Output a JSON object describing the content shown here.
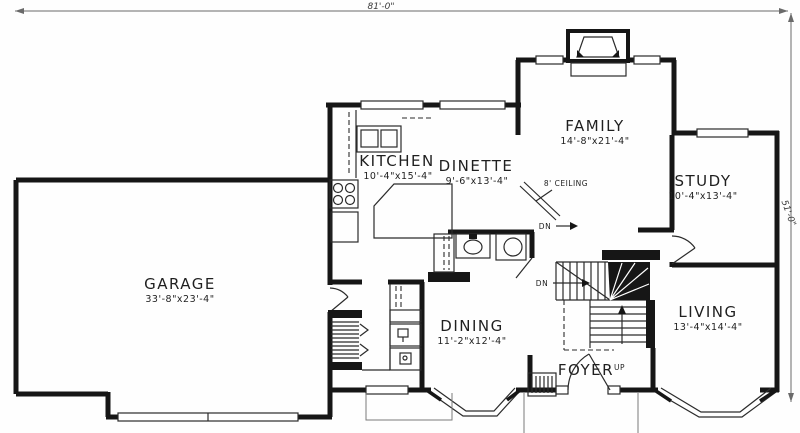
{
  "plan": {
    "type": "first-floor-plan",
    "overall_width": "81'-0\"",
    "overall_depth": "51'-0\""
  },
  "rooms": {
    "garage": {
      "name": "GARAGE",
      "size": "33'-8\"x23'-4\""
    },
    "kitchen": {
      "name": "KITCHEN",
      "size": "10'-4\"x15'-4\""
    },
    "dinette": {
      "name": "DINETTE",
      "size": "9'-6\"x13'-4\""
    },
    "family": {
      "name": "FAMILY",
      "size": "14'-8\"x21'-4\""
    },
    "study": {
      "name": "STUDY",
      "size": "10'-4\"x13'-4\""
    },
    "dining": {
      "name": "DINING",
      "size": "11'-2\"x12'-4\""
    },
    "living": {
      "name": "LIVING",
      "size": "13'-4\"x14'-4\""
    },
    "foyer": {
      "name": "FOYER"
    }
  },
  "notes": {
    "ceiling": "8' CEILING",
    "up": "UP",
    "dn_upper": "DN",
    "dn_lower": "DN"
  },
  "fixtures": [
    "fireplace-icon",
    "kitchen-sink-icon",
    "range-icon",
    "refrigerator-icon",
    "island-icon",
    "toilet-icon",
    "vanity-sink-icon",
    "washer-icon",
    "dryer-icon",
    "main-stairs",
    "basement-stairs",
    "front-door",
    "garage-entry-door",
    "study-door",
    "dining-bay-window",
    "living-bay-window"
  ],
  "colors": {
    "wall": "#161616",
    "background": "#fefefe",
    "thin_line": "#2b2b2b",
    "dimension": "#6a6a6a"
  }
}
